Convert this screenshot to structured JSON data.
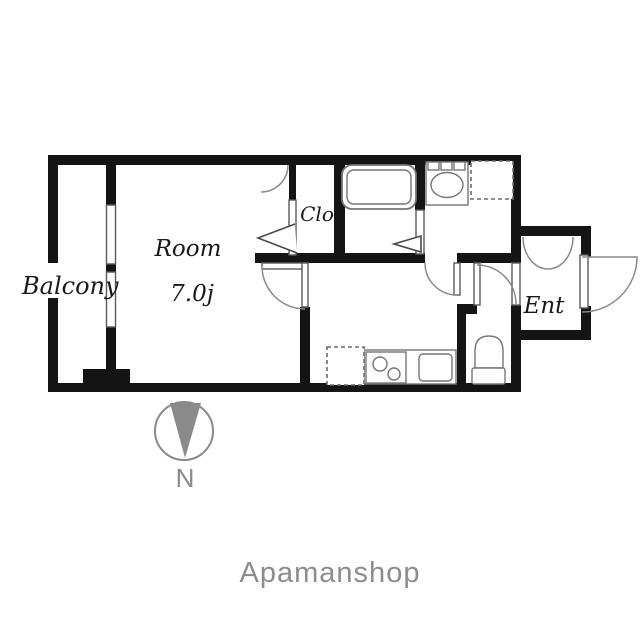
{
  "plan": {
    "rooms": {
      "balcony_label": "Balcony",
      "main_room_label": "Room",
      "main_room_size": "7.0j",
      "closet_label": "Clo",
      "entrance_label": "Ent"
    },
    "compass": {
      "north_label": "N"
    },
    "watermark_label": "Apamanshop",
    "colors": {
      "wall": "#141414",
      "label": "#1a1a1a",
      "fixture_outline": "#767676",
      "arc": "#8a8a8a",
      "compass": "#8a8a8a",
      "watermark": "#8d8d8d",
      "background": "#ffffff"
    }
  }
}
